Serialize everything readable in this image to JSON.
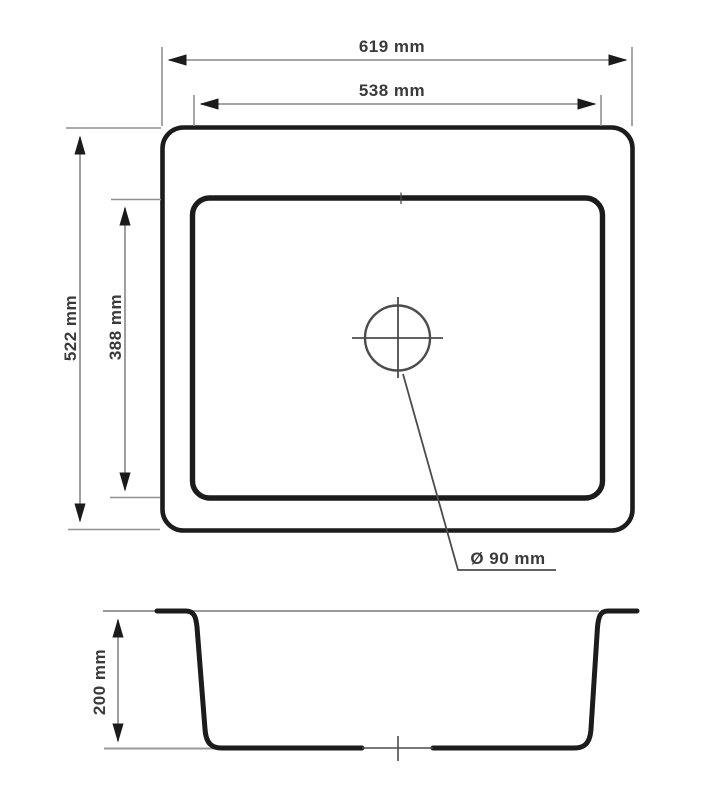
{
  "drawing": {
    "type": "technical-dimension-drawing",
    "subject": "rectangular kitchen sink with center drain, top view and cross-section",
    "colors": {
      "object_line": "#1c1c1c",
      "dimension_line": "#858585",
      "arrowhead": "#1b1b1b",
      "text": "#3a3a3a",
      "background": "#ffffff"
    },
    "labels": {
      "outer_width": "619 mm",
      "inner_width": "538 mm",
      "outer_height": "522 mm",
      "inner_height": "388 mm",
      "drain": "Ø 90 mm",
      "depth": "200 mm"
    },
    "measurements": [
      {
        "name": "outer_width",
        "value": 619,
        "unit": "mm",
        "view": "top"
      },
      {
        "name": "inner_width",
        "value": 538,
        "unit": "mm",
        "view": "top"
      },
      {
        "name": "outer_height",
        "value": 522,
        "unit": "mm",
        "view": "top"
      },
      {
        "name": "inner_height",
        "value": 388,
        "unit": "mm",
        "view": "top"
      },
      {
        "name": "drain_diameter",
        "value": 90,
        "unit": "mm",
        "view": "top"
      },
      {
        "name": "bowl_depth",
        "value": 200,
        "unit": "mm",
        "view": "section"
      }
    ]
  }
}
